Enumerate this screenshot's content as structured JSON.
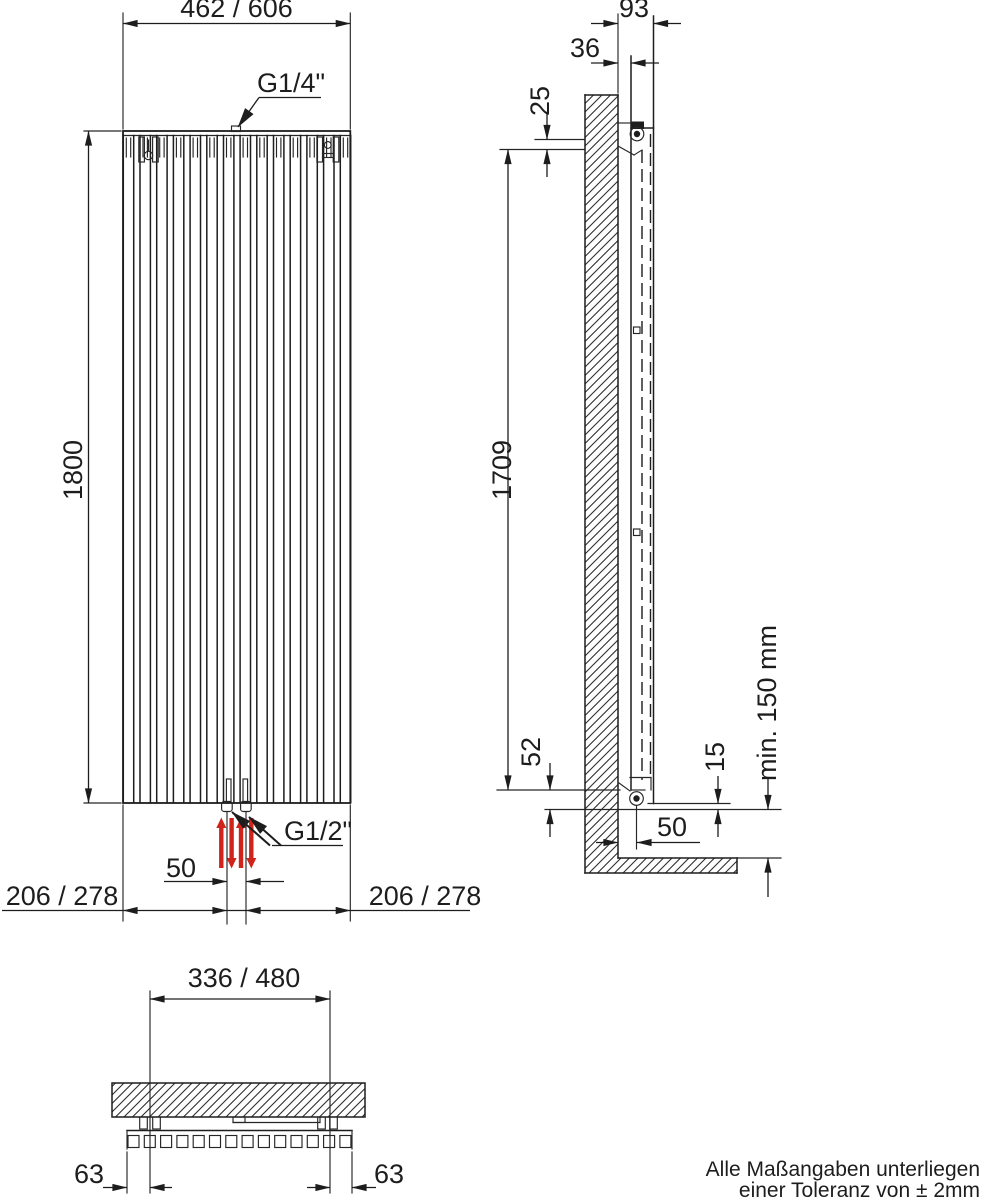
{
  "colors": {
    "ink": "#1d1d1d",
    "red": "#d0231c",
    "background": "#ffffff"
  },
  "front_view": {
    "width_dim": "462 / 606",
    "height_dim": "1800",
    "top_connection": "G1/4\"",
    "bottom_connection": "G1/2\"",
    "connection_spacing_dim": "50",
    "side_offset_left_dim": "206 / 278",
    "side_offset_right_dim": "206 / 278"
  },
  "side_view": {
    "total_depth_dim": "93",
    "wall_bracket_depth_dim": "36",
    "top_bracket_offset_dim": "25",
    "bracket_distance_dim": "1709",
    "bottom_bracket_offset_dim": "52",
    "bracket_foot_dim": "15",
    "bracket_wall_distance_dim": "50",
    "floor_clearance_dim": "min. 150 mm"
  },
  "bottom_view": {
    "bracket_spacing_dim": "336 / 480",
    "end_offset_left_dim": "63",
    "end_offset_right_dim": "63"
  },
  "note": {
    "line1": "Alle Maßangaben unterliegen",
    "line2": "einer Toleranz von ± 2mm"
  }
}
